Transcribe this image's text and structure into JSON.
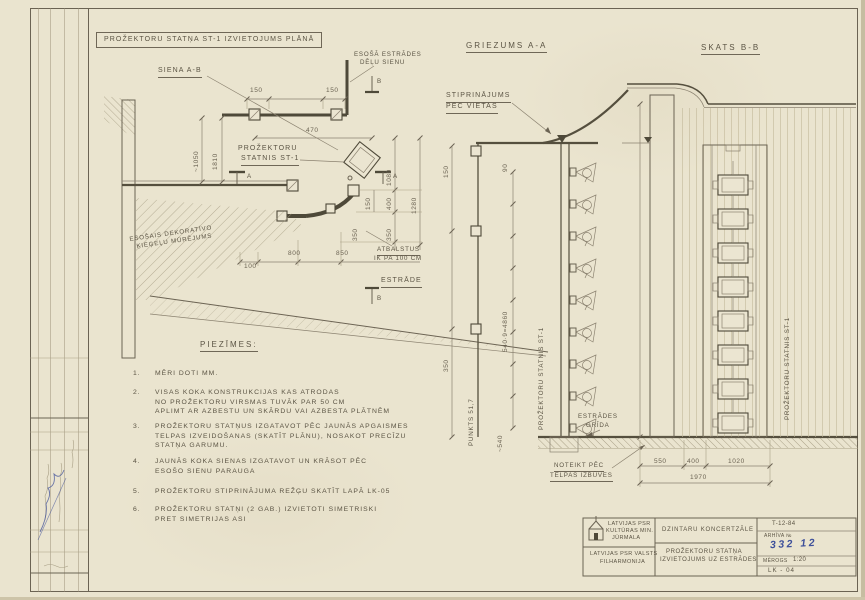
{
  "plan": {
    "title": "PROŽEKTORU STATŅA ST-1 IZVIETOJUMS PLĀNĀ",
    "wall_label": "SIENA A-B",
    "existing_wall_line1": "ESOŠĀ ESTRĀDES",
    "existing_wall_line2": "DĒĻU SIENU",
    "projector_line1": "PROŽEKTORU",
    "projector_line2": "STATNIS ST-1",
    "masonry_line1": "ESOŠAIS DEKORATĪVO",
    "masonry_line2": "ĶIEĢEĻU MŪRĒJUMS",
    "supports_line1": "ATBALSTUS",
    "supports_line2": "IK PA 100 CM",
    "stage_label": "ESTRĀDE",
    "marker_a": "A",
    "marker_b": "B",
    "dims": {
      "top_left": "150",
      "top_right": "150",
      "d470": "470",
      "left_v1": "~1050",
      "left_v2": "1810",
      "d1080": "1080",
      "d400": "400",
      "d350": "350",
      "d1280": "1280",
      "d150": "150",
      "d350b": "350",
      "d100": "100",
      "d800": "800",
      "d850": "850"
    }
  },
  "section_aa": {
    "title": "GRIEZUMS A-A",
    "fixing_line1": "STIPRINĀJUMS",
    "fixing_line2": "PĒC VIETAS",
    "post_label": "PROŽEKTORU STATNIS ST-1",
    "point_label": "PUNKTS 51,7",
    "floor_line1": "ESTRĀDES",
    "floor_line2": "GRĪDA",
    "note_line1": "NOTEIKT PĒC",
    "note_line2": "TELPAS IZBŪVES",
    "dims": {
      "spacing": "540·9=4860",
      "bottom": "~540",
      "top": "150",
      "mid": "350",
      "small": "90"
    }
  },
  "view_bb": {
    "title": "SKATS B-B",
    "post_label": "PROŽEKTORU STATNIS ST-1",
    "dims": {
      "d550": "550",
      "d400": "400",
      "d1020": "1020",
      "total": "1970"
    }
  },
  "notes": {
    "title": "PIEZĪMES:",
    "items": [
      {
        "num": "1.",
        "line1": "MĒRI DOTI MM.",
        "line2": "",
        "line3": ""
      },
      {
        "num": "2.",
        "line1": "VISAS KOKA KONSTRUKCIJAS KAS ATRODAS",
        "line2": "NO PROŽEKTORU VIRSMAS TUVĀK PAR 50 CM",
        "line3": "APLIMT AR AZBESTU UN SKĀRDU VAI AZBESTA PLĀTNĒM"
      },
      {
        "num": "3.",
        "line1": "PROŽEKTORU STATŅUS IZGATAVOT PĒC JAUNĀS APGAISMES",
        "line2": "TELPAS IZVEIDOŠANAS (SKATĪT PLĀNU), NOSAKOT PRECĪZU",
        "line3": "STATŅA GARUMU."
      },
      {
        "num": "4.",
        "line1": "JAUNĀS KOKA SIENAS IZGATAVOT UN KRĀSOT PĒC",
        "line2": "ESOŠO SIENU PARAUGA",
        "line3": ""
      },
      {
        "num": "5.",
        "line1": "PROŽEKTORU STIPRINĀJUMA REŽĢU SKATĪT LAPĀ LK-05",
        "line2": "",
        "line3": ""
      },
      {
        "num": "6.",
        "line1": "PROŽEKTORU STATŅI (2 GAB.) IZVIETOTI SIMETRISKI",
        "line2": "PRET SIMETRIJAS ASI",
        "line3": ""
      }
    ]
  },
  "title_block": {
    "org_line1": "LATVIJAS PSR",
    "org_line2": "KULTŪRAS MIN.",
    "org_line3": "JŪRMALA",
    "org2_line1": "LATVIJAS PSR VALSTS",
    "org2_line2": "FILHARMONIJA",
    "project": "DZINTARU KONCERTZĀLE",
    "sheet_line1": "PROŽEKTORU STATŅA",
    "sheet_line2": "IZVIETOJUMS UZ ESTRĀDES",
    "code": "T-12-84",
    "archive_label": "ARHĪVA №",
    "archive_no": "332 12",
    "scale_label": "MĒROGS",
    "scale_value": "1:20",
    "sheet_no": "LK - 04"
  },
  "colors": {
    "paper": "#eae4cf",
    "pencil": "#6b6353",
    "dark": "#4e4939",
    "blue_ink": "#3d4f9a"
  }
}
